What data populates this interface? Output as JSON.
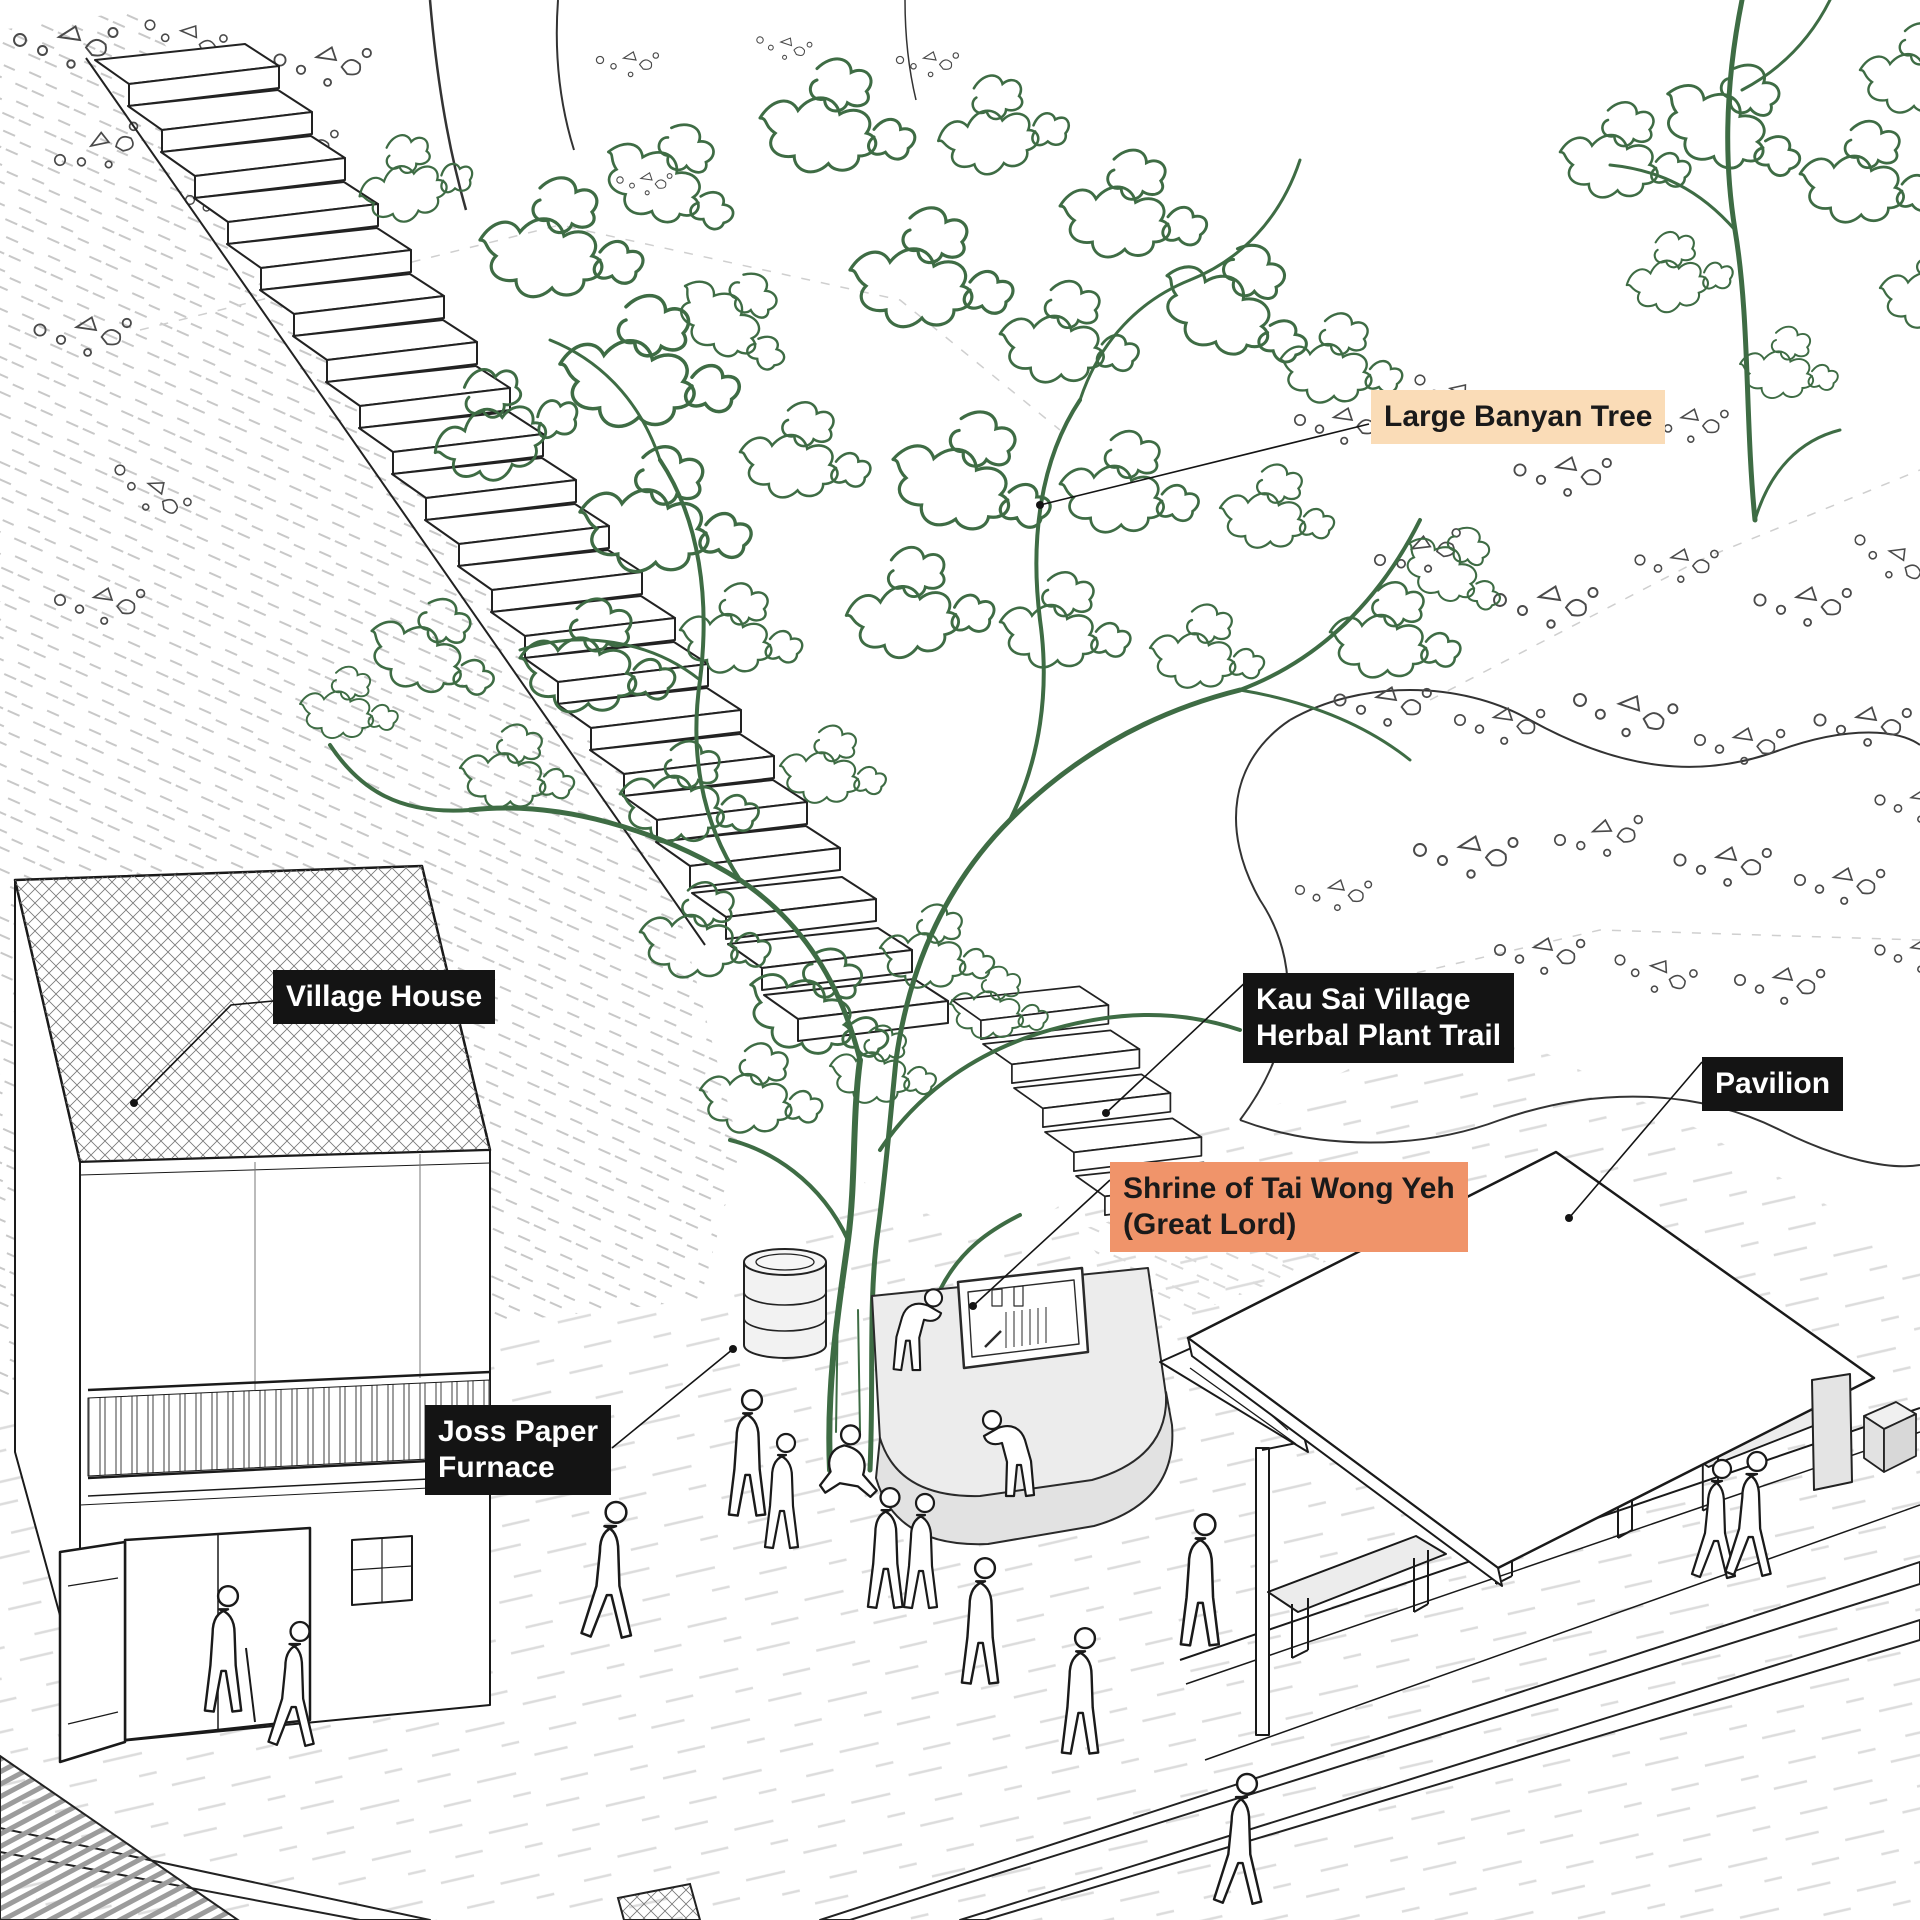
{
  "labels": {
    "large_banyan_tree": {
      "text": "Large Banyan Tree",
      "bg": "#fadcb7",
      "fg": "#1a1a1a"
    },
    "village_house": {
      "text": "Village House",
      "bg": "#141414",
      "fg": "#ffffff"
    },
    "herbal_plant_trail": {
      "text": "Kau Sai Village\nHerbal Plant Trail",
      "bg": "#141414",
      "fg": "#ffffff"
    },
    "pavilion": {
      "text": "Pavilion",
      "bg": "#141414",
      "fg": "#ffffff"
    },
    "shrine": {
      "text": "Shrine of Tai Wong Yeh\n(Great Lord)",
      "bg": "#f0946a",
      "fg": "#1a1a1a"
    },
    "joss_paper_furnace": {
      "text": "Joss Paper\nFurnace",
      "bg": "#141414",
      "fg": "#ffffff"
    }
  },
  "palette": {
    "foliage_green": "#3e6c44",
    "ink": "#1a1a1a",
    "highlight_peach": "#fadcb7",
    "highlight_orange": "#f0946a",
    "label_black": "#141414",
    "platform_gray": "#ececec",
    "ground_dash_gray": "#dcdcdc"
  }
}
